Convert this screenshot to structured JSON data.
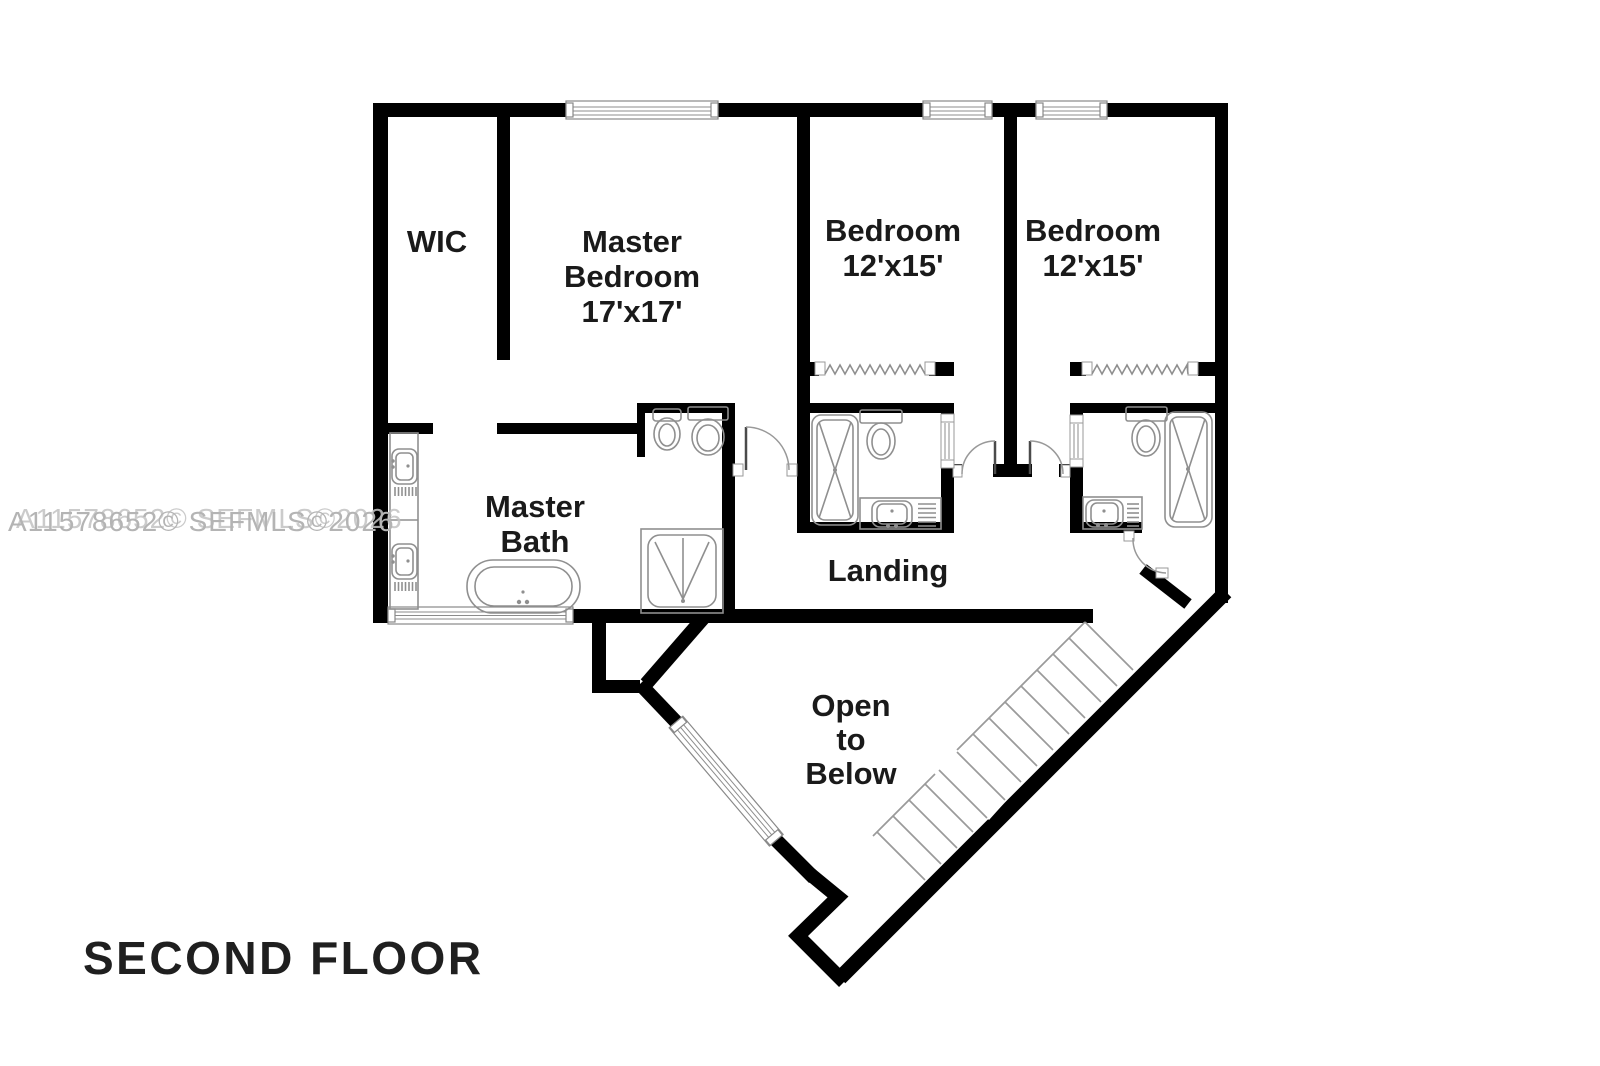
{
  "title": {
    "label": "SECOND FLOOR"
  },
  "watermark": {
    "text": "A11578652© SEFMLS©2026"
  },
  "rooms": {
    "wic": {
      "label": "WIC"
    },
    "master_bedroom": {
      "line1": "Master",
      "line2": "Bedroom",
      "line3": "17'x17'"
    },
    "bedroom_left": {
      "line1": "Bedroom",
      "line2": "12'x15'"
    },
    "bedroom_right": {
      "line1": "Bedroom",
      "line2": "12'x15'"
    },
    "master_bath": {
      "line1": "Master",
      "line2": "Bath"
    },
    "landing": {
      "label": "Landing"
    },
    "open_to_below": {
      "line1": "Open",
      "line2": "to",
      "line3": "Below"
    }
  },
  "colors": {
    "wall": "#000000",
    "fixture": "#8f8f8f",
    "stairs": "#9a9a9a",
    "label": "#1a1a1a",
    "watermark": "#b4b4b4",
    "title": "#1f1f1f",
    "background": "#ffffff"
  }
}
